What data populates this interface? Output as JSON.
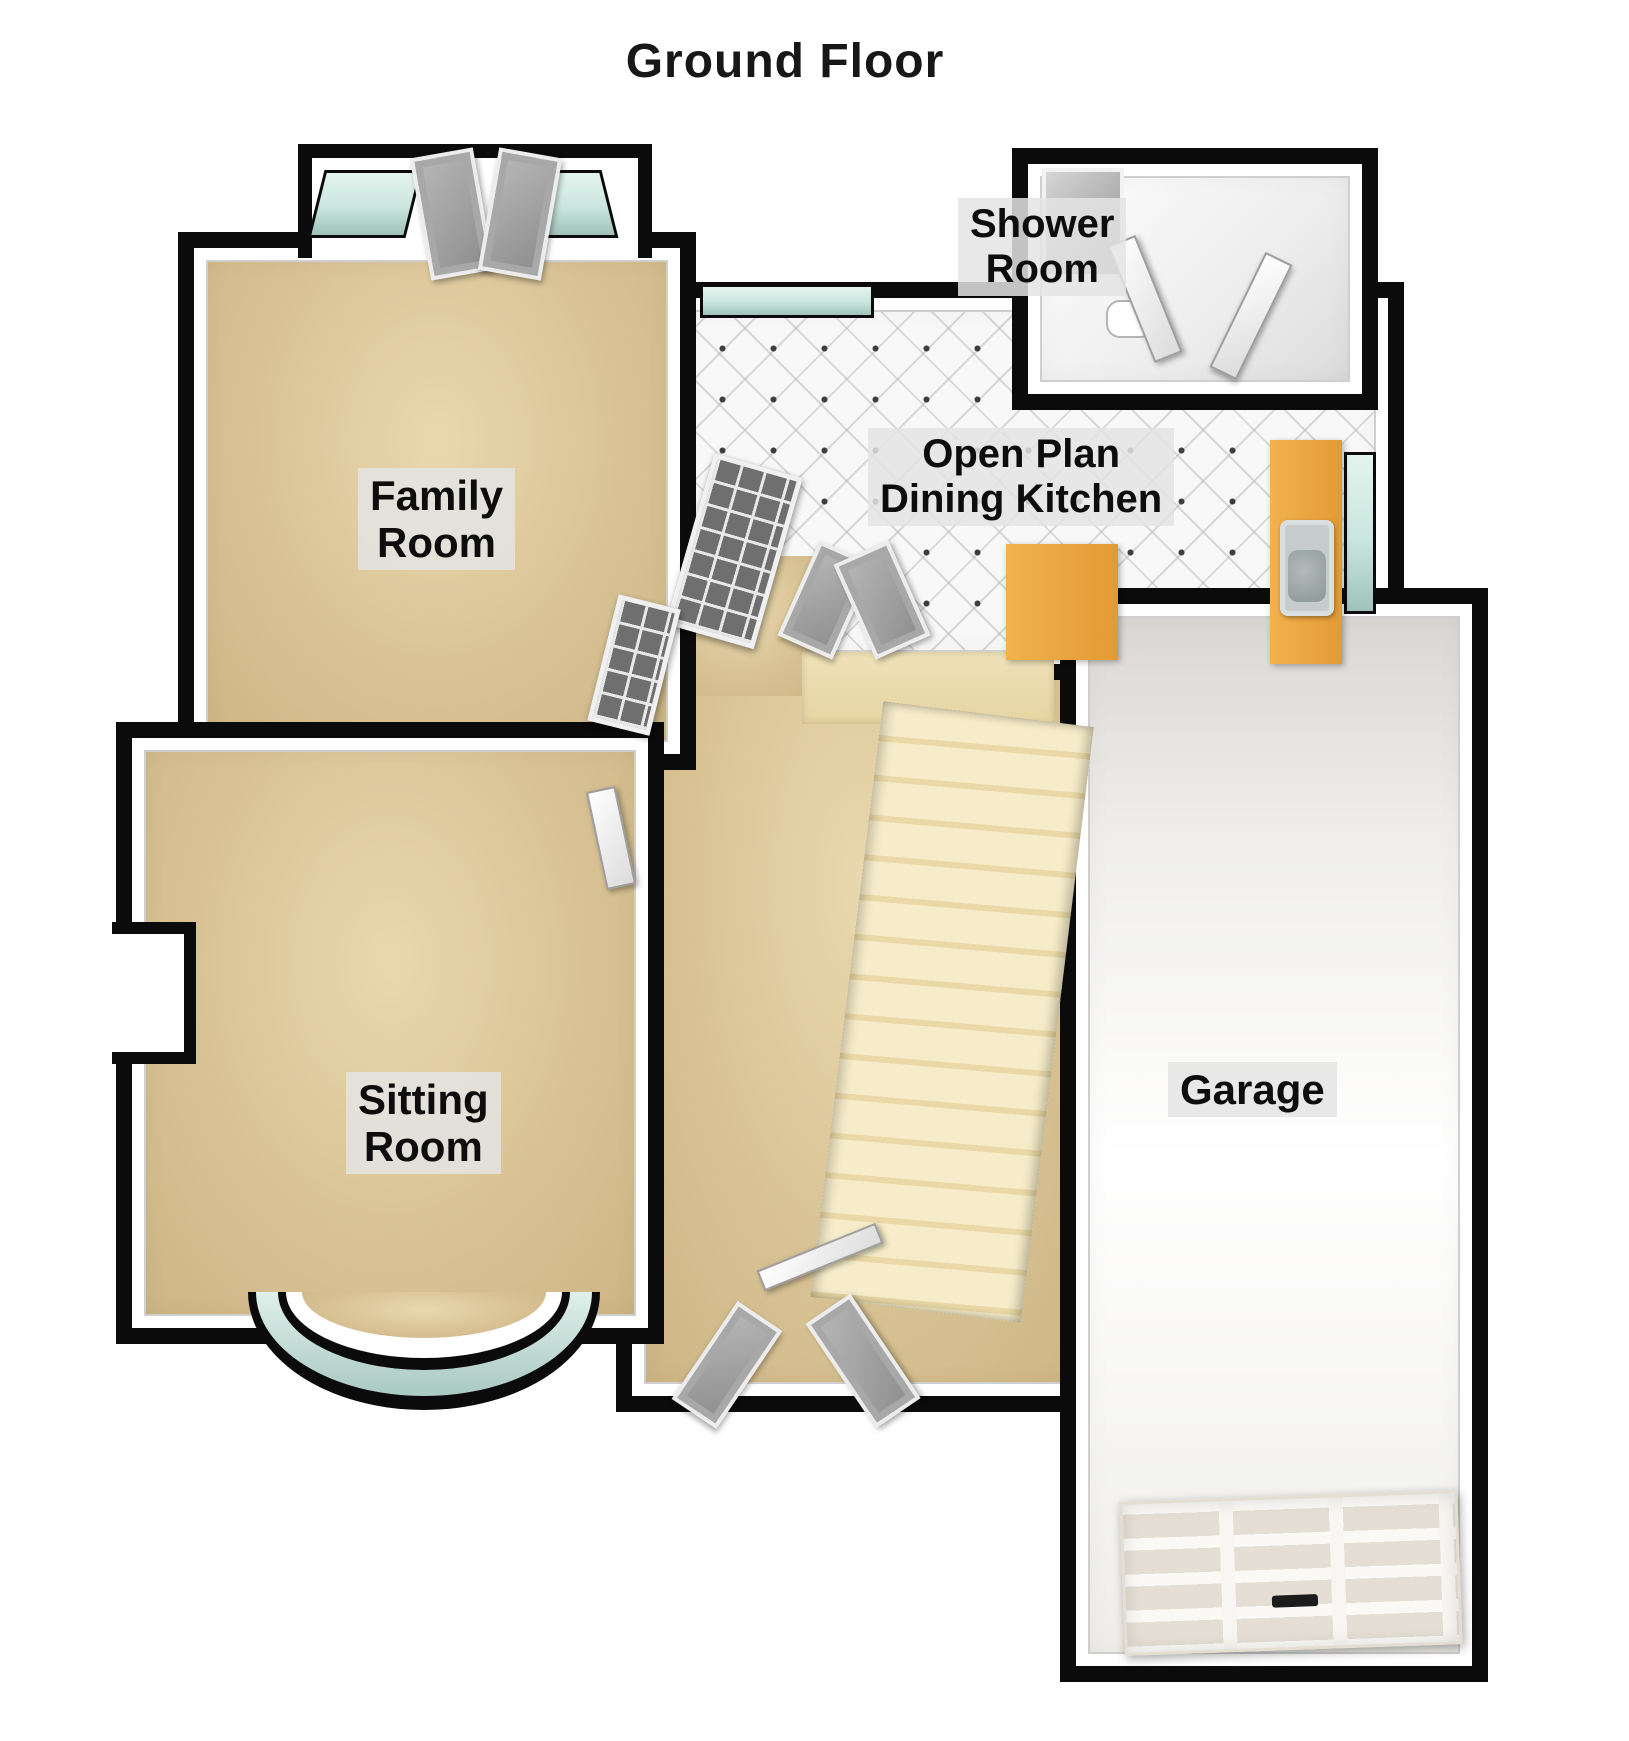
{
  "title": "Ground Floor",
  "rooms": {
    "family": {
      "label": "Family\nRoom"
    },
    "sitting": {
      "label": "Sitting\nRoom"
    },
    "shower": {
      "label": "Shower\nRoom"
    },
    "kitchen": {
      "label": "Open Plan\nDining Kitchen"
    },
    "garage": {
      "label": "Garage"
    }
  },
  "colors": {
    "wall": "#0b0b0b",
    "wood_floor": "#d8c294",
    "stairs": "#f0e3bb",
    "kitchen_tile": "#f7f7f7",
    "garage_floor": "#efeeea",
    "window_glass": "#cfe8e1",
    "counter_wood": "#eca440",
    "label_background": "#e6e6e6",
    "label_text": "#0d0d0d"
  }
}
